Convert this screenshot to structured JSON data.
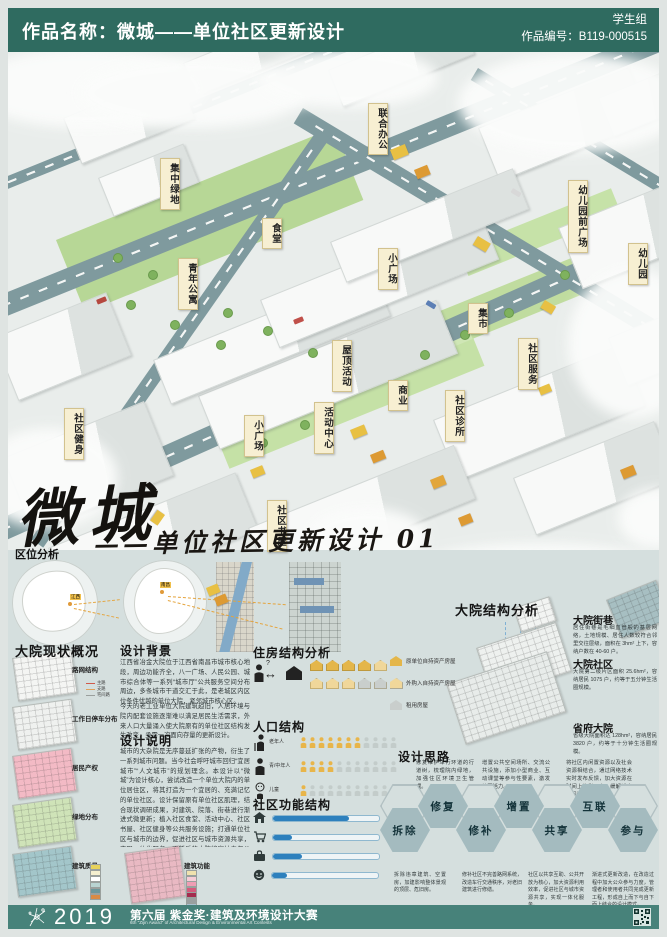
{
  "header": {
    "title": "作品名称：微城——单位社区更新设计",
    "group": "学生组",
    "number": "作品编号：B119-000515"
  },
  "map": {
    "labels": [
      "联合办公",
      "集中绿地",
      "食堂",
      "小广场",
      "青年公寓",
      "幼儿园前广场",
      "幼儿园",
      "集市",
      "社区服务",
      "社区诊所",
      "屋顶活动",
      "商业",
      "活动中心",
      "小广场",
      "社区健身",
      "社区书屋"
    ]
  },
  "title_block": {
    "main": "微城",
    "subtitle": "——单位社区更新设计 01"
  },
  "location": {
    "heading": "区位分析",
    "tags": [
      "江西",
      "南昌"
    ]
  },
  "courtyard": {
    "heading": "大院结构分析",
    "items": [
      {
        "title": "大院街巷",
        "text": "居住街巷是毛细血管般的基层网络，土地规模、居住人数较符合邻里交往层级，面积在 3hm² 上下，容纳户数在 40-60 户。"
      },
      {
        "title": "大院社区",
        "text": "大院第二级片区面积 25.6hm²，容纳居民 1075 户，约等于五分钟生活圈规模。"
      },
      {
        "title": "省府大院",
        "text": "省级大院面积达 128hm²，容纳居民 3820 户，约等于十分钟生活圈规模。"
      }
    ]
  },
  "status": {
    "heading": "大院现状概况",
    "plans": [
      "路网结构",
      "工作日停车分布",
      "居民产权",
      "绿地分布",
      "建筑质量"
    ],
    "road_legend": [
      "主路",
      "支路",
      "宅间路"
    ],
    "quality_legend_colors": [
      "#e7d25a",
      "#f5efcf",
      "#ffffff",
      "#b9d4d2",
      "#6b979b",
      "#d98a44"
    ]
  },
  "background": {
    "heading": "设计背景",
    "text1": "江西省冶金大院位于江西省南昌市城市核心地段，周边功能齐全，八一广场、人民公园、城市综合体等一系列“城市厅”公共服务空间分布周边，多条城市干道交汇于此，是老城区内区位条件优越的单位大院，紧邻城市核心区。",
    "text2": "今天的老工业单位大院建筑趋旧，人居环境与院内配套设施逐渐难以满足居民生活需求，外来人口大量涌入使大院原有的单位社区结构发生改变，亟需一次面向存量的更新设计。"
  },
  "description": {
    "heading": "设计说明",
    "text": "城市的大杂院是无序蔓延扩张的产物，衍生了一系列城市问题。当今社会呼吁城市回归“宜居城市”“人文城市”的规划理念。本设计以“微城”为设计核心，尝试改造一个单位大院内的单位居住区，将其打造为一个宜居的、充满记忆的单位社区。设计保留原有单位社区肌理，结合现状调研成果，对建筑、院落、街巷进行渐进式微更新；植入社区食堂、活动中心、社区书屋、社区健身等公共服务设施；打通单位社区与城市的边界，促进社区与城市资源共享，实现一体化服务。更新后的大院将容纳青年公寓、小型商业等多元功能，打造充满活力的混合人口社区，使老旧大院重新融入当代城市生活，形成自治共享的“微城”社区。",
    "function_label": "建筑功能",
    "function_legend_colors": [
      "#f0e2ae",
      "#f6ccd6",
      "#ef9db4",
      "#d45b7c",
      "#a32c4e",
      "#9aa0a0",
      "#a9c0d0"
    ]
  },
  "housing": {
    "heading": "住房结构分析",
    "question": "?",
    "legend": [
      "原单位自持资产房屋",
      "外购入自持资产房屋",
      "租用房屋"
    ],
    "house_rows": [
      [
        "solid",
        "solid",
        "solid",
        "solid",
        "outline"
      ],
      [
        "outline",
        "outline",
        "outline",
        "grey",
        "grey",
        "grey"
      ]
    ]
  },
  "population": {
    "heading": "人口结构",
    "rows": [
      {
        "label": "老年人",
        "highlight": 7,
        "total": 11
      },
      {
        "label": "青/中年人",
        "highlight": 4,
        "total": 11
      },
      {
        "label": "儿童",
        "highlight": 1,
        "total": 11
      }
    ]
  },
  "functions": {
    "heading": "社区功能结构",
    "bars": [
      {
        "icon": "home",
        "value": 72
      },
      {
        "icon": "cart",
        "value": 18
      },
      {
        "icon": "bag",
        "value": 27
      },
      {
        "icon": "face",
        "value": 14
      }
    ]
  },
  "ideas": {
    "heading": "设计思路",
    "top_notes": [
      "修复维护车行环道的行道树，梳理院内绿地，加强住区环境卫生管理。",
      "增置公共空间场所、交流公共设施，添加小型商业、互动课堂等参与性要素，激发社区活力。",
      "将社区内闲置资源以及社会资源相结合，通过网络技术实时发布反馈，加大资源在时间上的利用率，缓解城市空间资源紧缺问题。"
    ],
    "hexagons": [
      "拆除",
      "修复",
      "修补",
      "增置",
      "共享",
      "互联",
      "参与"
    ],
    "bottom_notes": [
      "拆除违章建筑、空置房，加建影响整体景观的顶层、危旧房。",
      "修补社区不完善路网系统，改造车行交通秩序，对老旧建筑进行修缮。",
      "社区以共享互助、公共开放为核心，加大资源利用效率，促进社区与城市资源共享，实现一体化服务。",
      "渐进式更新改造，在改造过程中加大公众参与力度，管理者和使用者共同完成更新工程，形成自上而下与自下而上结合的设计模式。"
    ]
  },
  "footer": {
    "year": "2019",
    "edition_title": "第六届 紫金奖·建筑及环境设计大赛",
    "subtitle_en": "6th \"Zijin Award\" of Architectural Design & Environmental Art Contests"
  }
}
